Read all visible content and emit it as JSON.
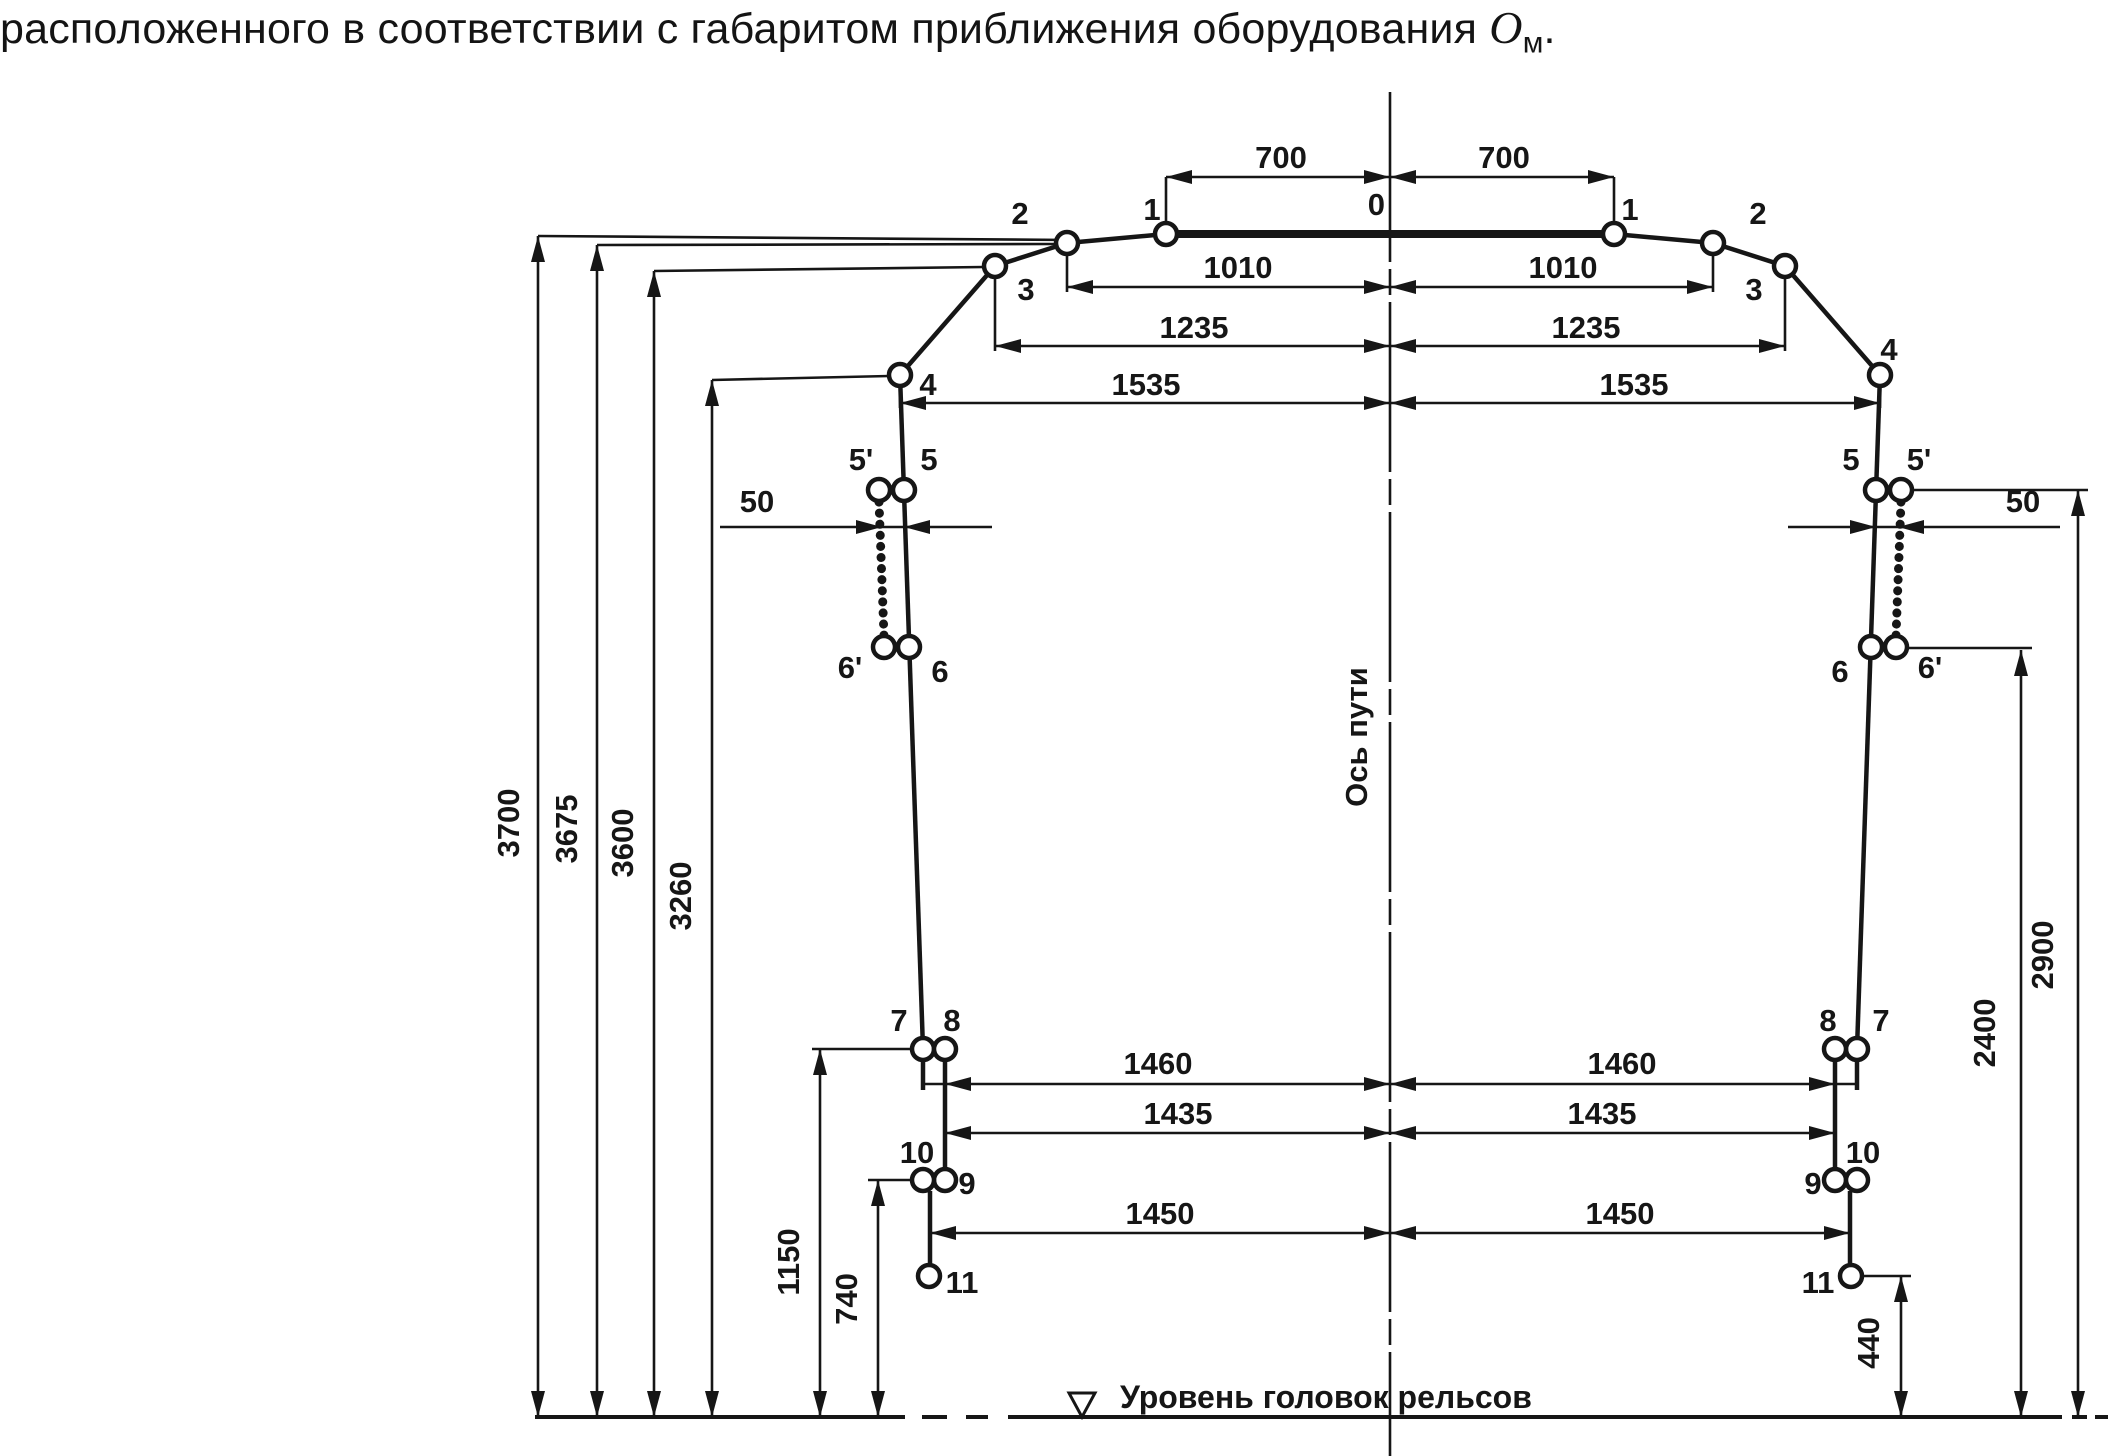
{
  "title": {
    "prefix": "расположенного в соответствии с габаритом приближения оборудования ",
    "symbol": "О",
    "subscript": "м",
    "suffix": "."
  },
  "labels": {
    "track_axis": "Ось пути",
    "rail_head_level": "Уровень головок рельсов"
  },
  "dimensions_mm": {
    "half_widths": [
      700,
      1010,
      1235,
      1535,
      1460,
      1435,
      1450
    ],
    "heights": [
      3700,
      3675,
      3600,
      3260,
      2900,
      2400,
      1150,
      740,
      440
    ],
    "side_offset": 50,
    "point_numbers": [
      "0",
      "1",
      "2",
      "3",
      "4",
      "5",
      "5'",
      "6",
      "6'",
      "7",
      "8",
      "9",
      "10",
      "11"
    ]
  },
  "style": {
    "ink": "#161616",
    "bg": "#ffffff"
  },
  "diagram": {
    "width": 2111,
    "height": 1456,
    "center_x": 1390,
    "rail_y": 1417,
    "geometry": {
      "thick": [
        [
          1166,
          234,
          1614,
          234
        ]
      ],
      "contour": [
        [
          1166,
          234,
          1067,
          243
        ],
        [
          1067,
          243,
          995,
          266
        ],
        [
          995,
          266,
          900,
          375
        ],
        [
          900,
          375,
          923,
          1049
        ],
        [
          923,
          1060,
          923,
          1090
        ],
        [
          945,
          1060,
          945,
          1169
        ],
        [
          930,
          1191,
          930,
          1265
        ],
        [
          1614,
          234,
          1713,
          243
        ],
        [
          1713,
          243,
          1785,
          266
        ],
        [
          1785,
          266,
          1880,
          375
        ],
        [
          1880,
          375,
          1857,
          1049
        ],
        [
          1857,
          1060,
          1857,
          1090
        ],
        [
          1835,
          1060,
          1835,
          1169
        ],
        [
          1850,
          1191,
          1850,
          1265
        ]
      ],
      "beaded": [
        [
          879,
          502,
          884,
          636
        ],
        [
          1901,
          502,
          1896,
          636
        ]
      ],
      "circles": [
        [
          1166,
          234
        ],
        [
          1067,
          243
        ],
        [
          995,
          266
        ],
        [
          900,
          375
        ],
        [
          904,
          490
        ],
        [
          879,
          490
        ],
        [
          909,
          647
        ],
        [
          884,
          647
        ],
        [
          923,
          1049
        ],
        [
          945,
          1049
        ],
        [
          945,
          1180
        ],
        [
          923,
          1180
        ],
        [
          929,
          1276
        ],
        [
          1614,
          234
        ],
        [
          1713,
          243
        ],
        [
          1785,
          266
        ],
        [
          1880,
          375
        ],
        [
          1876,
          490
        ],
        [
          1901,
          490
        ],
        [
          1871,
          647
        ],
        [
          1896,
          647
        ],
        [
          1857,
          1049
        ],
        [
          1835,
          1049
        ],
        [
          1835,
          1180
        ],
        [
          1857,
          1180
        ],
        [
          1851,
          1276
        ]
      ],
      "thin": [
        [
          1166,
          177,
          1614,
          177
        ],
        [
          1067,
          287,
          1713,
          287
        ],
        [
          995,
          346,
          1785,
          346
        ],
        [
          900,
          403,
          1880,
          403
        ],
        [
          923,
          1084,
          1857,
          1084
        ],
        [
          945,
          1133,
          1835,
          1133
        ],
        [
          930,
          1233,
          1850,
          1233
        ],
        [
          720,
          527,
          992,
          527
        ],
        [
          1788,
          527,
          2060,
          527
        ],
        [
          1166,
          177,
          1166,
          223
        ],
        [
          1614,
          177,
          1614,
          223
        ],
        [
          1067,
          254,
          1067,
          292
        ],
        [
          1713,
          254,
          1713,
          292
        ],
        [
          995,
          277,
          995,
          351
        ],
        [
          1785,
          277,
          1785,
          351
        ],
        [
          900,
          386,
          900,
          408
        ],
        [
          1880,
          386,
          1880,
          408
        ],
        [
          538,
          236,
          1070,
          240
        ],
        [
          597,
          245,
          1056,
          244
        ],
        [
          654,
          271,
          984,
          267
        ],
        [
          712,
          380,
          889,
          376
        ],
        [
          812,
          1049,
          912,
          1049
        ],
        [
          868,
          1180,
          912,
          1180
        ],
        [
          1862,
          1276,
          1911,
          1276
        ],
        [
          1907,
          648,
          2032,
          648
        ],
        [
          1912,
          490,
          2088,
          490
        ],
        [
          538,
          236,
          538,
          1417
        ],
        [
          597,
          245,
          597,
          1417
        ],
        [
          654,
          271,
          654,
          1417
        ],
        [
          712,
          380,
          712,
          1417
        ],
        [
          820,
          1049,
          820,
          1417
        ],
        [
          878,
          1180,
          878,
          1417
        ],
        [
          1901,
          1276,
          1901,
          1417
        ],
        [
          2021,
          650,
          2021,
          1417
        ],
        [
          2078,
          490,
          2078,
          1417
        ]
      ],
      "centerline": [
        1390,
        92,
        1390,
        1456
      ],
      "rail_segments": [
        [
          535,
          905
        ],
        [
          922,
          947
        ],
        [
          966,
          988
        ],
        [
          1008,
          2062
        ],
        [
          2072,
          2087
        ],
        [
          2095,
          2108
        ]
      ],
      "arrows": [
        {
          "x": 538,
          "y": 236,
          "d": "u"
        },
        {
          "x": 597,
          "y": 245,
          "d": "u"
        },
        {
          "x": 654,
          "y": 271,
          "d": "u"
        },
        {
          "x": 712,
          "y": 380,
          "d": "u"
        },
        {
          "x": 820,
          "y": 1049,
          "d": "u"
        },
        {
          "x": 878,
          "y": 1180,
          "d": "u"
        },
        {
          "x": 1901,
          "y": 1276,
          "d": "u"
        },
        {
          "x": 2021,
          "y": 650,
          "d": "u"
        },
        {
          "x": 2078,
          "y": 490,
          "d": "u"
        },
        {
          "x": 538,
          "y": 1417,
          "d": "d"
        },
        {
          "x": 597,
          "y": 1417,
          "d": "d"
        },
        {
          "x": 654,
          "y": 1417,
          "d": "d"
        },
        {
          "x": 712,
          "y": 1417,
          "d": "d"
        },
        {
          "x": 820,
          "y": 1417,
          "d": "d"
        },
        {
          "x": 878,
          "y": 1417,
          "d": "d"
        },
        {
          "x": 1901,
          "y": 1417,
          "d": "d"
        },
        {
          "x": 2021,
          "y": 1417,
          "d": "d"
        },
        {
          "x": 2078,
          "y": 1417,
          "d": "d"
        },
        {
          "x": 1166,
          "y": 177,
          "d": "l"
        },
        {
          "x": 1067,
          "y": 287,
          "d": "l"
        },
        {
          "x": 995,
          "y": 346,
          "d": "l"
        },
        {
          "x": 900,
          "y": 403,
          "d": "l"
        },
        {
          "x": 945,
          "y": 1084,
          "d": "l"
        },
        {
          "x": 945,
          "y": 1133,
          "d": "l"
        },
        {
          "x": 930,
          "y": 1233,
          "d": "l"
        },
        {
          "x": 904,
          "y": 527,
          "d": "l"
        },
        {
          "x": 1898,
          "y": 527,
          "d": "l"
        },
        {
          "x": 1390,
          "y": 177,
          "d": "l"
        },
        {
          "x": 1390,
          "y": 287,
          "d": "l"
        },
        {
          "x": 1390,
          "y": 346,
          "d": "l"
        },
        {
          "x": 1390,
          "y": 403,
          "d": "l"
        },
        {
          "x": 1390,
          "y": 1084,
          "d": "l"
        },
        {
          "x": 1390,
          "y": 1133,
          "d": "l"
        },
        {
          "x": 1390,
          "y": 1233,
          "d": "l"
        },
        {
          "x": 1614,
          "y": 177,
          "d": "r"
        },
        {
          "x": 1713,
          "y": 287,
          "d": "r"
        },
        {
          "x": 1785,
          "y": 346,
          "d": "r"
        },
        {
          "x": 1880,
          "y": 403,
          "d": "r"
        },
        {
          "x": 1835,
          "y": 1084,
          "d": "r"
        },
        {
          "x": 1835,
          "y": 1133,
          "d": "r"
        },
        {
          "x": 1850,
          "y": 1233,
          "d": "r"
        },
        {
          "x": 882,
          "y": 527,
          "d": "r"
        },
        {
          "x": 1876,
          "y": 527,
          "d": "r"
        },
        {
          "x": 1390,
          "y": 177,
          "d": "r"
        },
        {
          "x": 1390,
          "y": 287,
          "d": "r"
        },
        {
          "x": 1390,
          "y": 346,
          "d": "r"
        },
        {
          "x": 1390,
          "y": 403,
          "d": "r"
        },
        {
          "x": 1390,
          "y": 1084,
          "d": "r"
        },
        {
          "x": 1390,
          "y": 1133,
          "d": "r"
        },
        {
          "x": 1390,
          "y": 1233,
          "d": "r"
        }
      ],
      "level_triangle": [
        [
          1069,
          1393
        ],
        [
          1095,
          1393
        ],
        [
          1082,
          1417
        ]
      ],
      "point_texts": [
        {
          "t": "0",
          "x": 1385,
          "y": 215,
          "a": "end"
        },
        {
          "t": "1",
          "x": 1152,
          "y": 220
        },
        {
          "t": "1",
          "x": 1630,
          "y": 220
        },
        {
          "t": "2",
          "x": 1020,
          "y": 224
        },
        {
          "t": "2",
          "x": 1758,
          "y": 224
        },
        {
          "t": "3",
          "x": 1026,
          "y": 300
        },
        {
          "t": "3",
          "x": 1754,
          "y": 300
        },
        {
          "t": "4",
          "x": 928,
          "y": 395
        },
        {
          "t": "4",
          "x": 1889,
          "y": 360
        },
        {
          "t": "5'",
          "x": 861,
          "y": 470
        },
        {
          "t": "5",
          "x": 929,
          "y": 470
        },
        {
          "t": "5",
          "x": 1851,
          "y": 470
        },
        {
          "t": "5'",
          "x": 1919,
          "y": 470
        },
        {
          "t": "6'",
          "x": 850,
          "y": 678
        },
        {
          "t": "6",
          "x": 940,
          "y": 682
        },
        {
          "t": "6",
          "x": 1840,
          "y": 682
        },
        {
          "t": "6'",
          "x": 1930,
          "y": 678
        },
        {
          "t": "7",
          "x": 899,
          "y": 1031
        },
        {
          "t": "8",
          "x": 952,
          "y": 1031
        },
        {
          "t": "8",
          "x": 1828,
          "y": 1031
        },
        {
          "t": "7",
          "x": 1881,
          "y": 1031
        },
        {
          "t": "10",
          "x": 917,
          "y": 1163
        },
        {
          "t": "9",
          "x": 967,
          "y": 1194
        },
        {
          "t": "10",
          "x": 1863,
          "y": 1163
        },
        {
          "t": "9",
          "x": 1813,
          "y": 1194
        },
        {
          "t": "11",
          "x": 962,
          "y": 1293
        },
        {
          "t": "11",
          "x": 1818,
          "y": 1293
        }
      ],
      "dim_texts": [
        {
          "t": "700",
          "x": 1281,
          "y": 168
        },
        {
          "t": "700",
          "x": 1504,
          "y": 168
        },
        {
          "t": "1010",
          "x": 1238,
          "y": 278
        },
        {
          "t": "1010",
          "x": 1563,
          "y": 278
        },
        {
          "t": "1235",
          "x": 1194,
          "y": 338
        },
        {
          "t": "1235",
          "x": 1586,
          "y": 338
        },
        {
          "t": "1535",
          "x": 1146,
          "y": 395
        },
        {
          "t": "1535",
          "x": 1634,
          "y": 395
        },
        {
          "t": "1460",
          "x": 1158,
          "y": 1074
        },
        {
          "t": "1460",
          "x": 1622,
          "y": 1074
        },
        {
          "t": "1435",
          "x": 1178,
          "y": 1124
        },
        {
          "t": "1435",
          "x": 1602,
          "y": 1124
        },
        {
          "t": "1450",
          "x": 1160,
          "y": 1224
        },
        {
          "t": "1450",
          "x": 1620,
          "y": 1224
        },
        {
          "t": "50",
          "x": 757,
          "y": 512
        },
        {
          "t": "50",
          "x": 2023,
          "y": 512
        }
      ],
      "rot_texts": [
        {
          "t": "3700",
          "x": 519,
          "y": 823
        },
        {
          "t": "3675",
          "x": 577,
          "y": 829
        },
        {
          "t": "3600",
          "x": 633,
          "y": 843
        },
        {
          "t": "3260",
          "x": 691,
          "y": 896
        },
        {
          "t": "1150",
          "x": 799,
          "y": 1262
        },
        {
          "t": "740",
          "x": 857,
          "y": 1299
        },
        {
          "t": "440",
          "x": 1879,
          "y": 1343
        },
        {
          "t": "2400",
          "x": 1995,
          "y": 1033
        },
        {
          "t": "2900",
          "x": 2053,
          "y": 955
        }
      ],
      "axis_text": {
        "x": 1367,
        "y": 737
      },
      "rail_text": {
        "x": 1120,
        "y": 1408
      }
    }
  }
}
